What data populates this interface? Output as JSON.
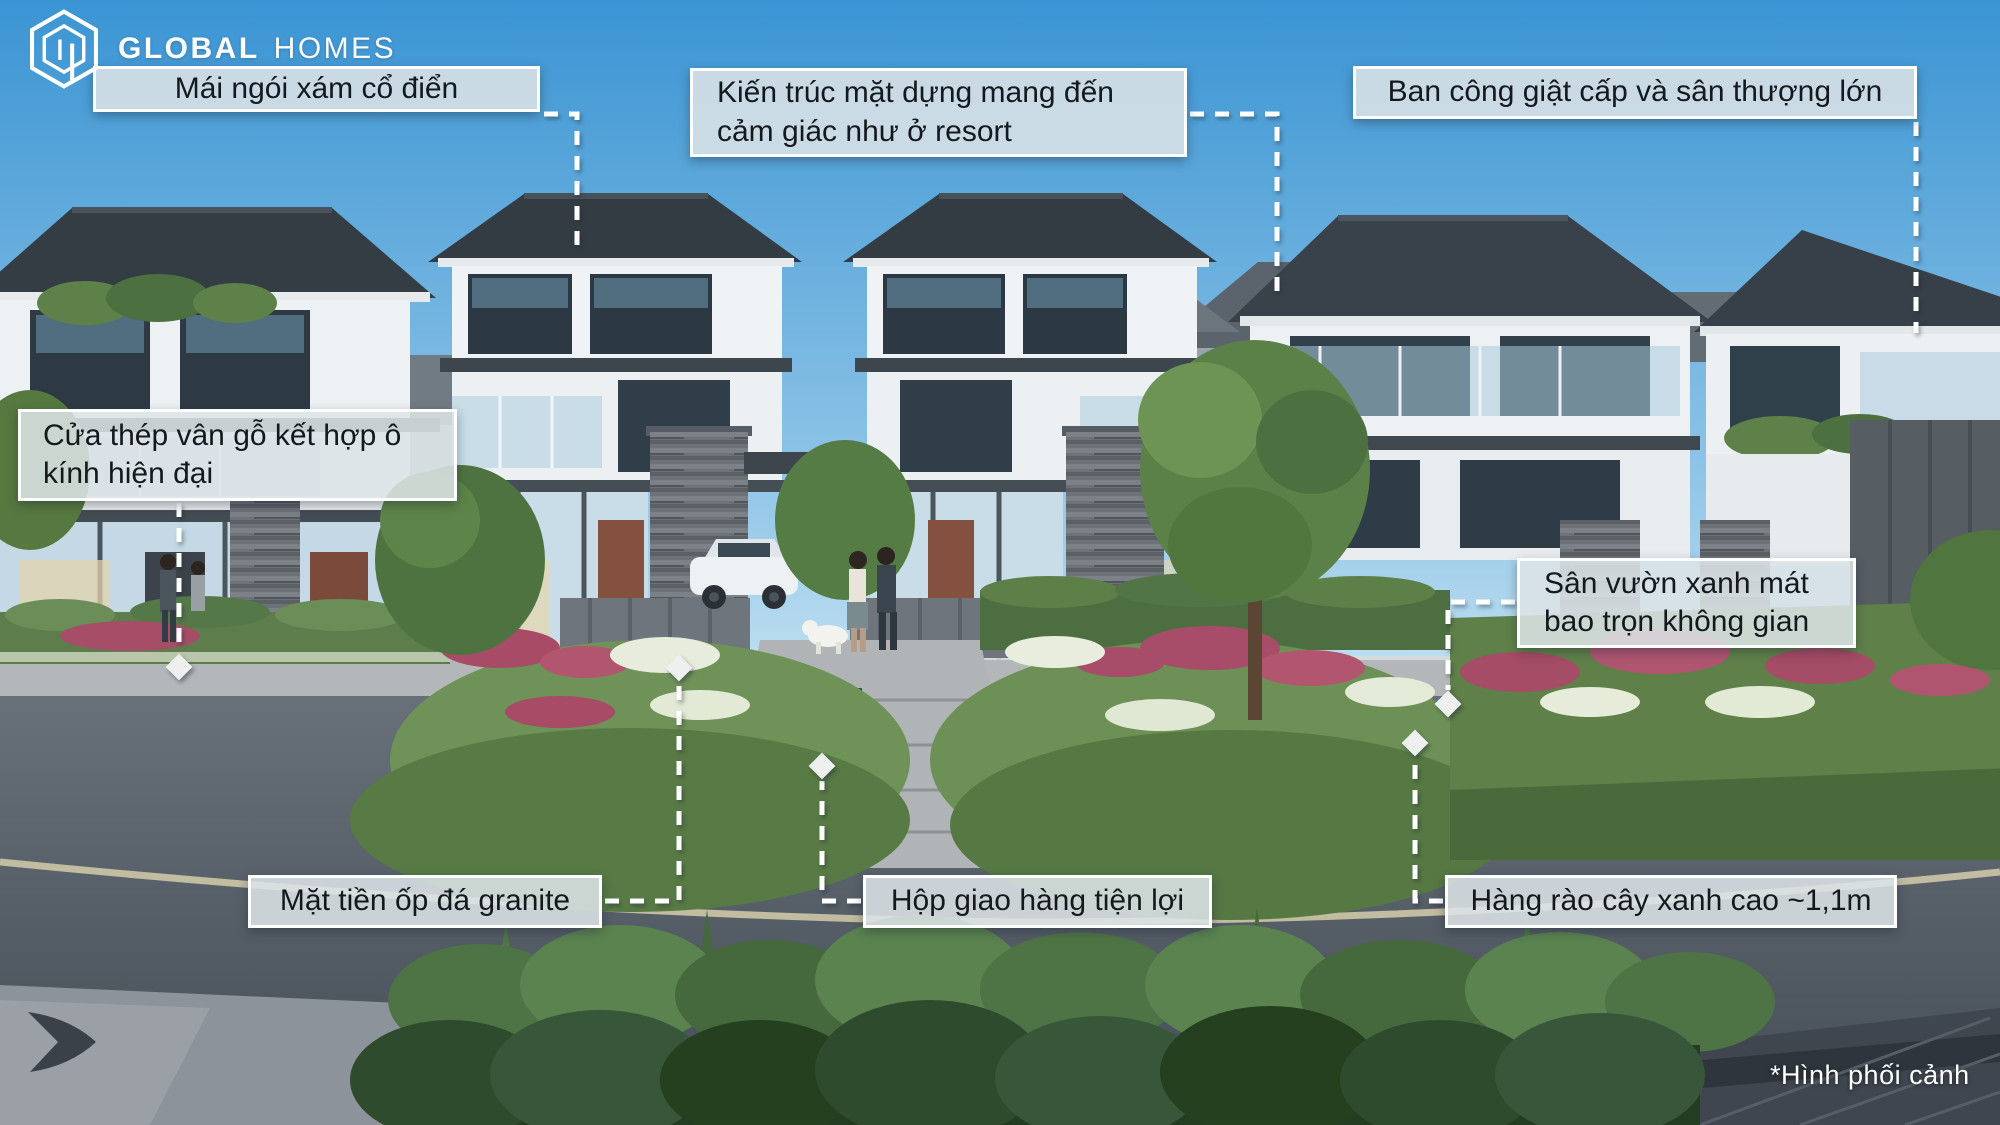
{
  "brand": {
    "icon": "hexagon-building-logo-icon",
    "word_bold": "GLOBAL",
    "word_light": "HOMES"
  },
  "callouts": [
    {
      "id": "roof-tiles",
      "label": "Mái ngói xám cổ điển"
    },
    {
      "id": "facade-resort",
      "label": "Kiến trúc mặt dựng mang đến\ncảm giác như ở resort"
    },
    {
      "id": "balcony-terrace",
      "label": "Ban công giật cấp và sân thượng lớn"
    },
    {
      "id": "steel-door",
      "label": "Cửa thép vân gỗ kết hợp ô\nkính hiện đại"
    },
    {
      "id": "green-garden",
      "label": "Sân vườn xanh mát\nbao trọn không gian"
    },
    {
      "id": "granite-facade",
      "label": "Mặt tiền ốp đá granite"
    },
    {
      "id": "delivery-box",
      "label": "Hộp giao hàng tiện lợi"
    },
    {
      "id": "green-fence",
      "label": "Hàng rào cây xanh cao ~1,1m"
    }
  ],
  "footnote": "*Hình phối cảnh",
  "colors": {
    "sky_top": "#3a94d3",
    "sky_horizon": "#c8e4f3",
    "roof": "#353d45",
    "callout_bg": "#dde3e7",
    "leader_line": "#ffffff",
    "text": "#14191d"
  }
}
